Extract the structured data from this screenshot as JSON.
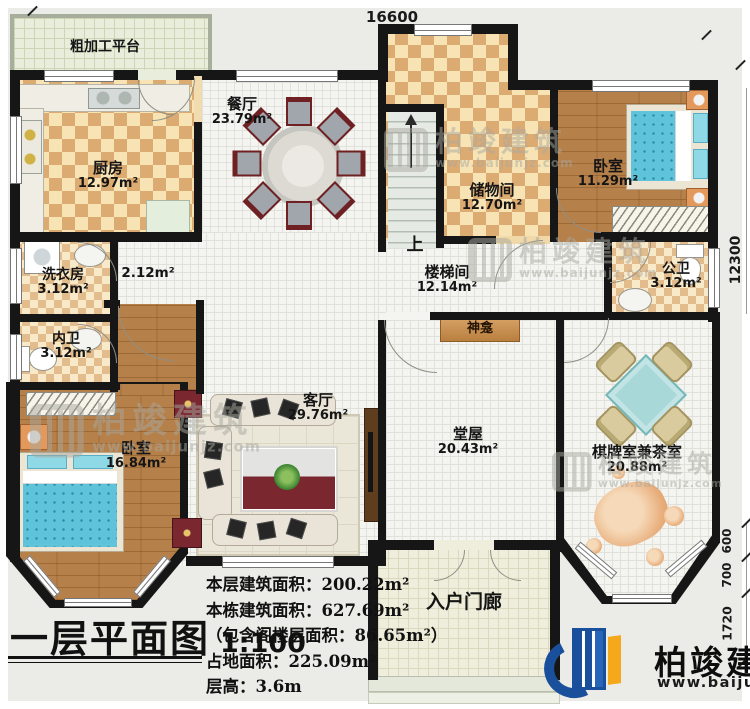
{
  "plan": {
    "dimensions": {
      "top_width": "16600",
      "right_height": "12300",
      "dim_600": "600",
      "dim_700": "700",
      "dim_1720": "1720"
    },
    "rooms": {
      "platform": {
        "name": "粗加工平台"
      },
      "kitchen": {
        "name": "厨房",
        "area": "12.97m²"
      },
      "dining": {
        "name": "餐厅",
        "area": "23.79m²"
      },
      "storage": {
        "name": "储物间",
        "area": "12.70m²"
      },
      "bedroom_ne": {
        "name": "卧室",
        "area": "11.29m²"
      },
      "stairwell": {
        "name": "楼梯间",
        "area": "12.14m²",
        "up": "上"
      },
      "hallway": {
        "area": "2.12m²"
      },
      "laundry": {
        "name": "洗衣房",
        "area": "3.12m²"
      },
      "inner_bath": {
        "name": "内卫",
        "area": "3.12m²"
      },
      "public_bath": {
        "name": "公卫",
        "area": "3.12m²"
      },
      "bedroom_sw": {
        "name": "卧室",
        "area": "16.84m²"
      },
      "living": {
        "name": "客厅",
        "area": "29.76m²"
      },
      "shrine": {
        "name": "神龛"
      },
      "main_hall": {
        "name": "堂屋",
        "area": "20.43m²"
      },
      "chess_tea": {
        "name": "棋牌室兼茶室",
        "area": "20.88m²"
      },
      "porch": {
        "name": "入户门廊"
      }
    }
  },
  "title_block": {
    "title": "一层平面图",
    "scale": "1:100",
    "stats": {
      "floor_area": "本层建筑面积：200.22m²",
      "building_area": "本栋建筑面积：627.69m²",
      "attic_note": "（包含阁楼层面积：86.65m²）",
      "footprint": "占地面积：225.09m²",
      "story_height": "层高：3.6m"
    }
  },
  "branding": {
    "logo_text": "柏竣建筑",
    "logo_url": "www.baijunjz.com"
  },
  "watermark": {
    "text": "柏竣建筑",
    "url": "www.baijunjz.com"
  },
  "colors": {
    "wall": "#161616",
    "brand_blue": "#1a4f9c",
    "brand_orange": "#f5a81c",
    "bed_blue": "#5fc3da",
    "wood": "#b5804a"
  }
}
